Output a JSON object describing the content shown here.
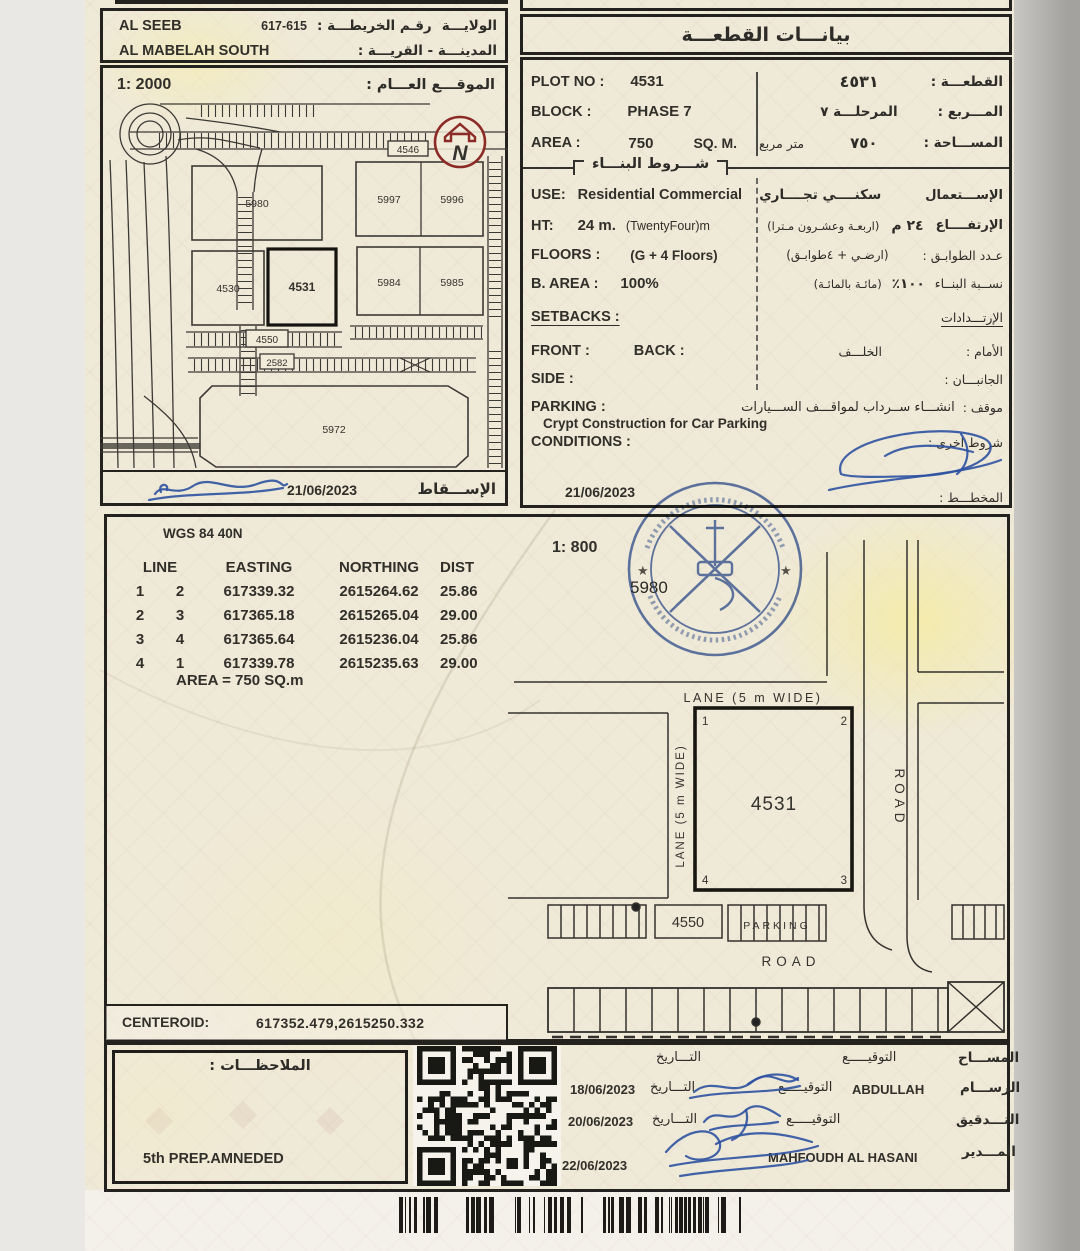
{
  "document": {
    "region": "AL SEEB",
    "region_label": "الولايـــة",
    "map_no_label": "رقـم الخريطـــة :",
    "map_no": "617-615",
    "town": "AL MABELAH SOUTH",
    "town_label": "المدينـــة - القريـــة :"
  },
  "site_plan": {
    "scale": "1: 2000",
    "title": "الموقـــع العـــام :",
    "north": "N",
    "plots": {
      "p5980": "5980",
      "p5997": "5997",
      "p5996": "5996",
      "p4530": "4530",
      "p4531": "4531",
      "p5984": "5984",
      "p5985": "5985",
      "p4546": "4546",
      "p4550": "4550",
      "p5972": "5972",
      "p2582": "2582"
    },
    "date": "21/06/2023",
    "caption": "الإســـقاط"
  },
  "plot_info": {
    "title": "بيانـــات القطعـــة",
    "plot_no_label": "PLOT NO :",
    "plot_no": "4531",
    "plot_no_ar": "٤٥٣١",
    "plot_no_label_ar": "القطعـــة :",
    "block_label": "BLOCK :",
    "block": "PHASE 7",
    "block_ar": "المرحلـــة ٧",
    "block_label_ar": "المـــربع :",
    "area_label": "AREA :",
    "area": "750",
    "area_unit": "SQ. M.",
    "area_unit_ar": "متر مربع",
    "area_ar": "٧٥٠",
    "area_label_ar": "المســـاحة :",
    "conditions_title": "شـــروط البنـــاء",
    "use_label": "USE:",
    "use": "Residential Commercial",
    "use_ar": "سكنــــي تجــــاري",
    "use_label_ar": "الإســـتعمال",
    "ht_label": "HT:",
    "ht": "24 m.",
    "ht_note": "(TwentyFour)m",
    "ht_ar": "٢٤ م",
    "ht_note_ar": "(اربعـة وعشـرون مـترا)",
    "ht_label_ar": "الإرتفــــاع",
    "floors_label": "FLOORS :",
    "floors": "(G + 4 Floors)",
    "floors_ar": "(ارضـي + ٤طوابـق)",
    "floors_label_ar": "عـدد الطوابـق :",
    "barea_label": "B. AREA :",
    "barea": "100%",
    "barea_ar": "١٠٠٪",
    "barea_note_ar": "(مائـة بالمائـة)",
    "barea_label_ar": "نســبة البنــاء",
    "setbacks_label": "SETBACKS :",
    "setbacks_label_ar": "الإرتـــدادات",
    "front_label": "FRONT :",
    "back_label": "BACK :",
    "back_ar": "الخلـــف",
    "front_label_ar": "الأمام :",
    "side_label": "SIDE :",
    "side_label_ar": "الجانبـــان :",
    "parking_label": "PARKING :",
    "parking": "Crypt Construction for Car Parking",
    "parking_ar": "انشـــاء ســرداب لمواقـــف الســـيارات",
    "parking_label_ar": "موقف :",
    "conditions_label": "CONDITIONS :",
    "conditions_label_ar": "شروط اخرى :",
    "date": "21/06/2023",
    "planner_label_ar": "المخطـــط :"
  },
  "survey": {
    "datum": "WGS 84  40N",
    "scale": "1: 800",
    "headers": {
      "line": "LINE",
      "easting": "EASTING",
      "northing": "NORTHING",
      "dist": "DIST"
    },
    "rows": [
      {
        "a": "1",
        "b": "2",
        "easting": "617339.32",
        "northing": "2615264.62",
        "dist": "25.86"
      },
      {
        "a": "2",
        "b": "3",
        "easting": "617365.18",
        "northing": "2615265.04",
        "dist": "29.00"
      },
      {
        "a": "3",
        "b": "4",
        "easting": "617365.64",
        "northing": "2615236.04",
        "dist": "25.86"
      },
      {
        "a": "4",
        "b": "1",
        "easting": "617339.78",
        "northing": "2615235.63",
        "dist": "29.00"
      }
    ],
    "area_line": "AREA = 750  SQ.m",
    "centeroid_label": "CENTEROID:",
    "centeroid_value": "617352.479,2615250.332"
  },
  "diagram": {
    "lane_top": "LANE (5 m WIDE)",
    "lane_left": "LANE (5 m WIDE)",
    "plot_no": "4531",
    "c1": "1",
    "c2": "2",
    "c3": "3",
    "c4": "4",
    "road_right": "ROAD",
    "road_bottom": "ROAD",
    "plot_4550": "4550",
    "parking": "PARKING",
    "plot_5980": "5980"
  },
  "notes": {
    "title": "الملاحظـــات :",
    "note": "5th PREP.AMNEDED"
  },
  "signoff": {
    "surveyor_label": "المســـاح",
    "sign_label": "التوقيـــــع",
    "date_label": "التـــاريخ",
    "draftsman_label": "الرســـام",
    "draftsman_name": "ABDULLAH",
    "draftsman_date": "18/06/2023",
    "audit_label": "التـــدقيق",
    "audit_date": "20/06/2023",
    "manager_label": "المـــدير",
    "manager_name": "MAHFOUDH AL HASANI",
    "manager_date": "22/06/2023"
  }
}
